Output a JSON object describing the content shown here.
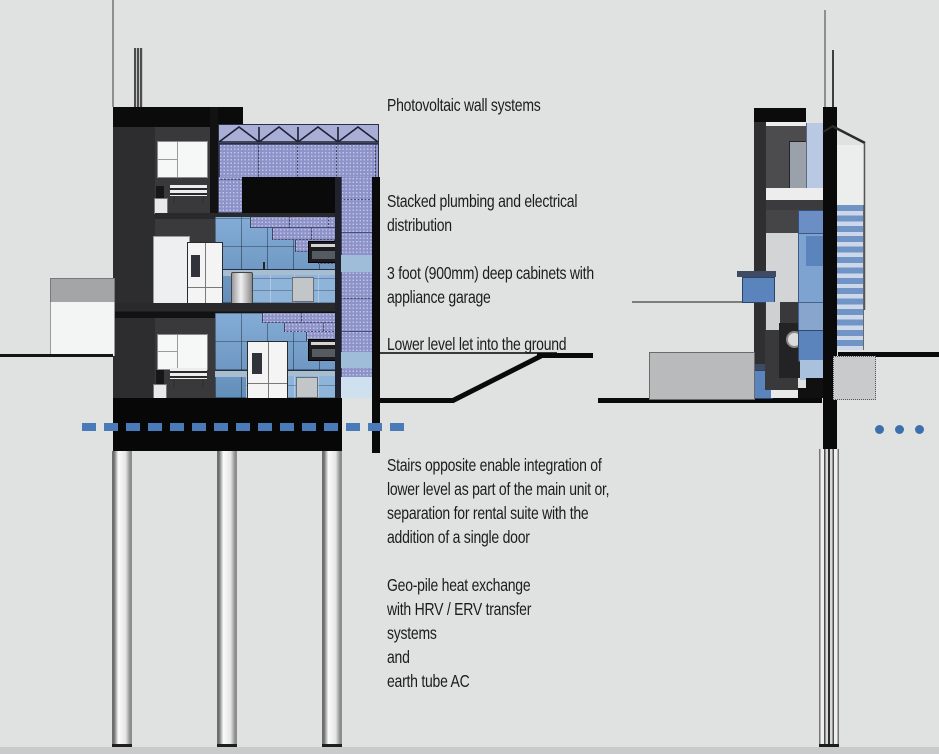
{
  "diagram_title": "Building section diagram — sustainable systems annotations",
  "annotations": {
    "photovoltaic": {
      "lines": [
        "Photovoltaic wall systems"
      ]
    },
    "plumbing": {
      "lines": [
        "Stacked plumbing and electrical",
        "distribution"
      ]
    },
    "cabinets": {
      "lines": [
        "3 foot  (900mm) deep cabinets with",
        "appliance garage"
      ]
    },
    "lower_level": {
      "lines": [
        "Lower level let into the ground"
      ]
    },
    "stairs": {
      "lines": [
        "Stairs opposite enable integration of",
        "lower level as part of the main unit or,",
        "separation for rental suite with the",
        "addition of a single door"
      ]
    },
    "geo_pile": {
      "lines": [
        "Geo-pile heat exchange",
        "with HRV / ERV  transfer",
        "systems",
        "and",
        "earth tube AC"
      ]
    }
  },
  "colors": {
    "background": "#e0e1e1",
    "structure_black": "#0a0a0a",
    "wall_dark": "#2e2e30",
    "pv_panel_blue": "#8d92c9",
    "glass_blue": "#6f9ecf",
    "fixture_blue": "#5b84bd",
    "stair_blue": "#7094c6",
    "datum_dash_blue": "#4a7ab8",
    "ellipsis_dot_blue": "#3e6fad",
    "text": "#1c1c1e"
  }
}
